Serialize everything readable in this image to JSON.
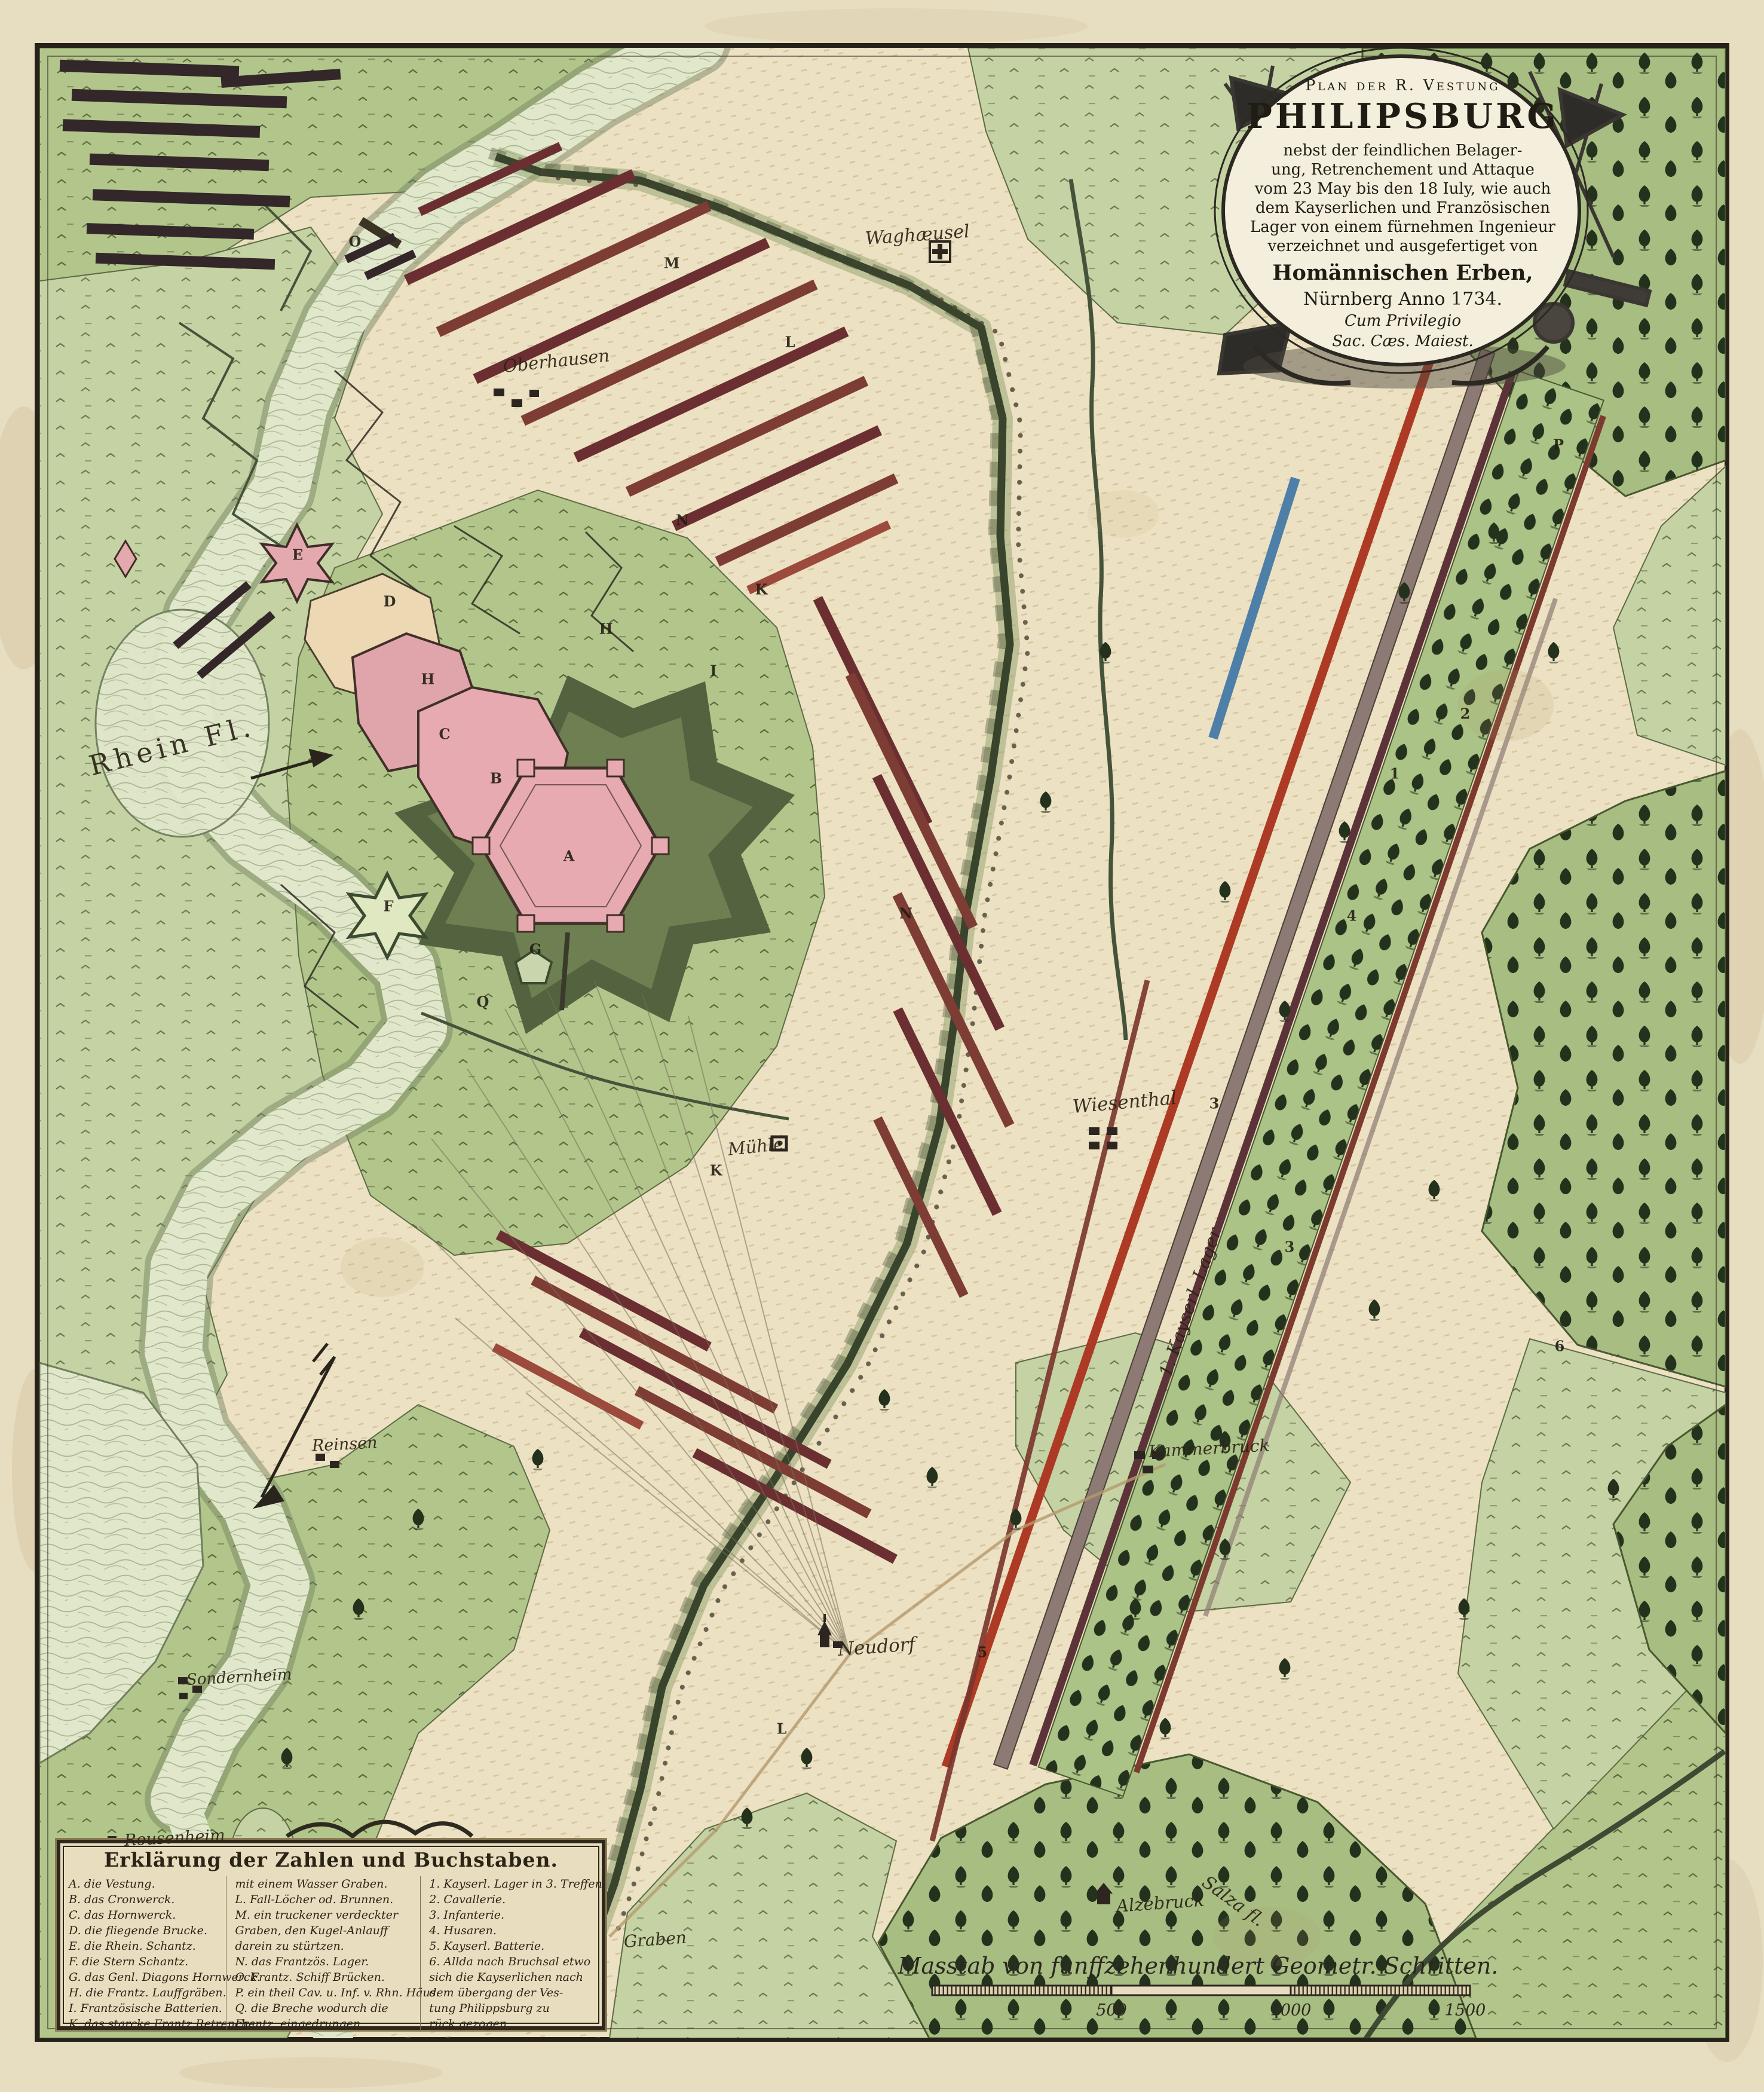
{
  "map": {
    "cartouche": {
      "kicker": "Plan der R. Vestung",
      "title": "PHILIPSBURG",
      "lines": [
        "nebst der feindlichen Belager-",
        "ung, Retrenchement und Attaque",
        "vom 23 May bis den 18 Iuly, wie auch",
        "dem Kayserlichen und Französischen",
        "Lager von einem fürnehmen Ingenieur",
        "verzeichnet und ausgefertiget von"
      ],
      "publisher": "Homännischen Erben,",
      "imprint": "Nürnberg Anno 1734.",
      "privilege1": "Cum Privilegio",
      "privilege2": "Sac. Cæs. Maiest."
    },
    "legend": {
      "title": "Erklärung der Zahlen und Buchstaben.",
      "col1": [
        "A. die Vestung.",
        "B. das Cronwerck.",
        "C. das Hornwerck.",
        "D. die fliegende Brucke.",
        "E. die Rhein. Schantz.",
        "F. die Stern Schantz.",
        "G. das Genl. Diagons Hornwerck.",
        "H. die Frantz. Lauffgräben.",
        "I. Frantzösische Batterien.",
        "K. das starcke Frantz Retrenche."
      ],
      "col2": [
        "mit einem Wasser Graben.",
        "L. Fall-Löcher od. Brunnen.",
        "M. ein truckener verdeckter",
        "Graben, den Kugel-Anlauff",
        "darein zu stürtzen.",
        "N. das Frantzös. Lager.",
        "O. Frantz. Schiff Brücken.",
        "P. ein theil Cav. u. Inf. v. Rhn. Häus.",
        "Q. die Breche wodurch die",
        "Frantz. eingedrungen."
      ],
      "col3": [
        "1. Kayserl. Lager in 3. Treffen.",
        "2. Cavallerie.",
        "3. Infanterie.",
        "4. Husaren.",
        "5. Kayserl. Batterie.",
        "6. Allda nach Bruchsal etwo",
        "sich die Kayserlichen nach",
        "dem übergang der Ves-",
        "tung Philippsburg zu",
        "rück gezogen."
      ]
    },
    "scale_bar": {
      "label": "Masstab von funffzehenhundert Geometr. Schritten.",
      "ticks": [
        "500",
        "1000",
        "1500"
      ]
    },
    "labels": [
      {
        "text": "Rhein Fl."
      },
      {
        "text": "Waghæusel"
      },
      {
        "text": "Oberhausen"
      },
      {
        "text": "Wiesenthal"
      },
      {
        "text": "Mühle"
      },
      {
        "text": "1. Kayserl. Lager"
      },
      {
        "text": "Kammerbruck"
      },
      {
        "text": "Neudorf"
      },
      {
        "text": "Alzebruck"
      },
      {
        "text": "Graben"
      },
      {
        "text": "Reinsen"
      },
      {
        "text": "Sondernheim"
      },
      {
        "text": "Rousenheim"
      },
      {
        "text": "Salza fl."
      }
    ],
    "markers": [
      {
        "t": "A"
      },
      {
        "t": "B"
      },
      {
        "t": "C"
      },
      {
        "t": "D"
      },
      {
        "t": "E"
      },
      {
        "t": "F"
      },
      {
        "t": "G"
      },
      {
        "t": "H"
      },
      {
        "t": "H"
      },
      {
        "t": "I"
      },
      {
        "t": "K"
      },
      {
        "t": "K"
      },
      {
        "t": "L"
      },
      {
        "t": "L"
      },
      {
        "t": "M"
      },
      {
        "t": "N"
      },
      {
        "t": "N"
      },
      {
        "t": "O"
      },
      {
        "t": "P"
      },
      {
        "t": "Q"
      },
      {
        "t": "1"
      },
      {
        "t": "2"
      },
      {
        "t": "3"
      },
      {
        "t": "3"
      },
      {
        "t": "4"
      },
      {
        "t": "5"
      },
      {
        "t": "6"
      }
    ],
    "colors": {
      "paper": "#e7dec2",
      "meadow_light": "#c5d2a3",
      "meadow_mid": "#b2c68b",
      "forest_green": "#a7bd82",
      "tree_ink": "#24321d",
      "water": "#e1e7ca",
      "fortress_pink": "#e7aab1",
      "rampart_olive": "#53623f",
      "camp_maroon": "#6b2f31",
      "camp_red": "#ad3a25",
      "line_blue": "#4d7fa8",
      "ink": "#2c2822"
    }
  }
}
